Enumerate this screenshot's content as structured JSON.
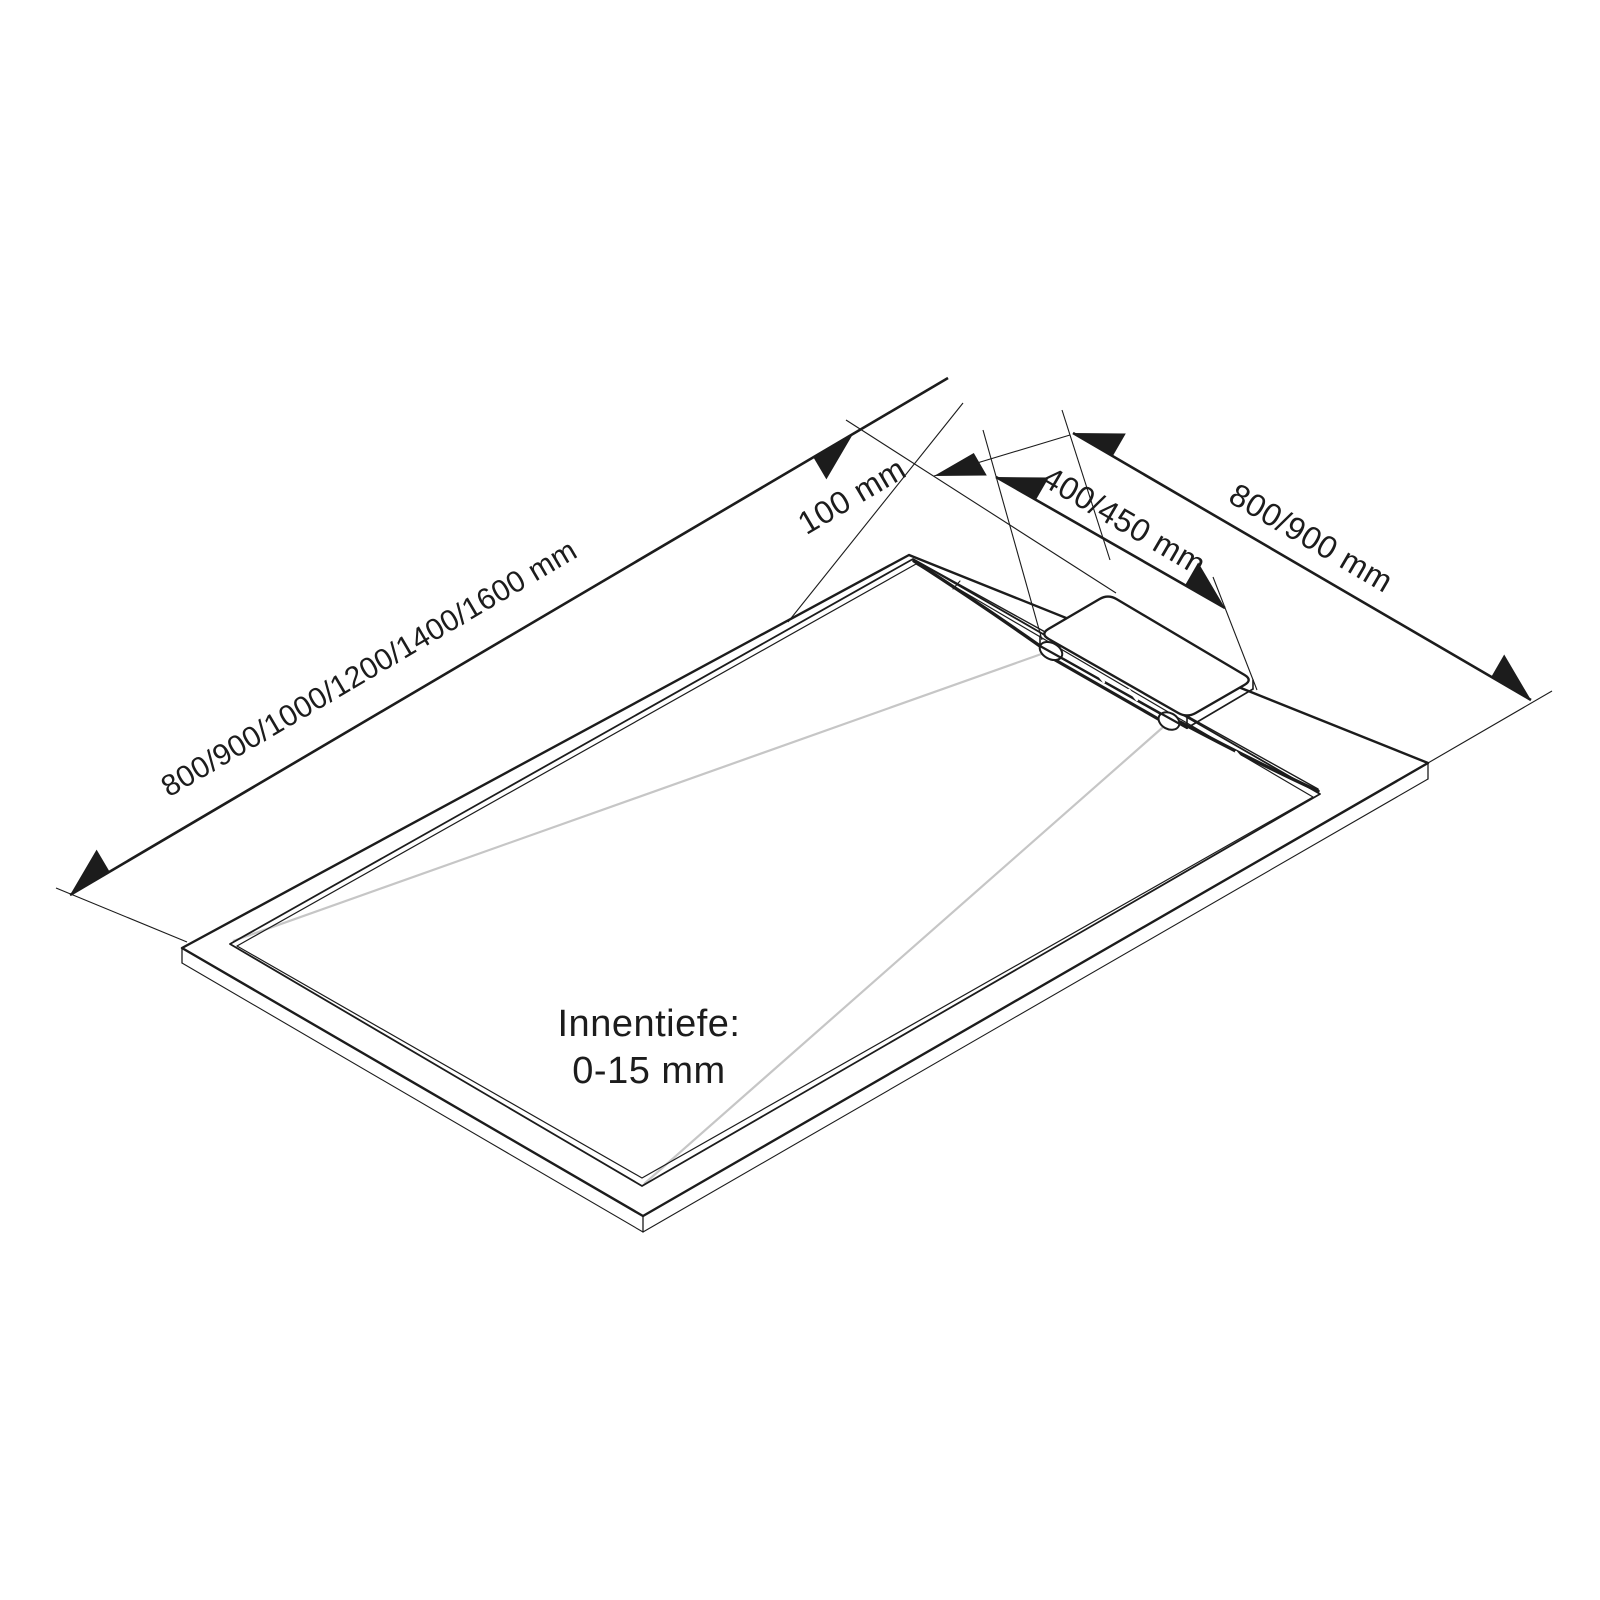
{
  "labels": {
    "length": "800/900/1000/1200/1400/1600 mm",
    "drain_offset": "100 mm",
    "drain_position": "400/450 mm",
    "width": "800/900 mm",
    "inner_depth_title": "Innentiefe:",
    "inner_depth_value": "0-15 mm"
  },
  "colors": {
    "line": "#1c1c1c",
    "fold_line": "#c6c6c6",
    "background": "#ffffff"
  }
}
